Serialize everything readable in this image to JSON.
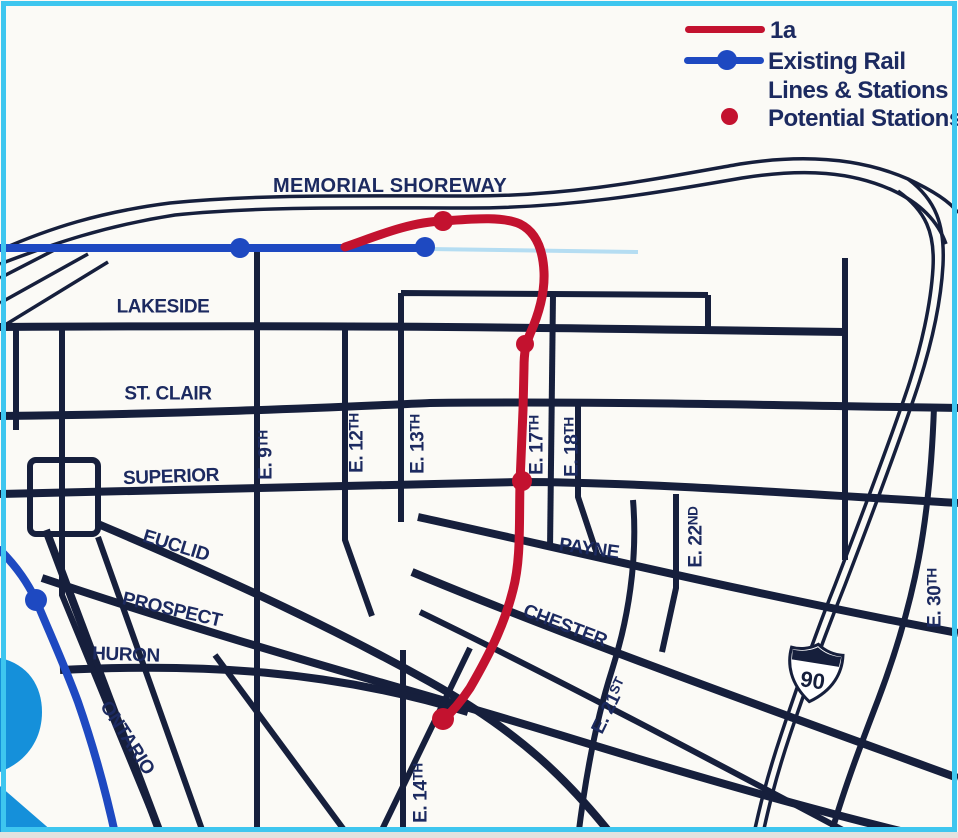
{
  "legend": {
    "route_label": "1a",
    "existing_line1": "Existing Rail",
    "existing_line2": "Lines & Stations",
    "potential_label": "Potential Stations"
  },
  "highway_shield": {
    "number": "90"
  },
  "map": {
    "labels": [
      {
        "id": "memorial-shoreway",
        "main": "MEMORIAL SHOREWAY",
        "suffix": ""
      },
      {
        "id": "lakeside",
        "main": "LAKESIDE",
        "suffix": ""
      },
      {
        "id": "st-clair",
        "main": "ST. CLAIR",
        "suffix": ""
      },
      {
        "id": "superior",
        "main": "SUPERIOR",
        "suffix": ""
      },
      {
        "id": "euclid",
        "main": "EUCLID",
        "suffix": ""
      },
      {
        "id": "prospect",
        "main": "PROSPECT",
        "suffix": ""
      },
      {
        "id": "huron",
        "main": "HURON",
        "suffix": ""
      },
      {
        "id": "ontario",
        "main": "ONTARIO",
        "suffix": ""
      },
      {
        "id": "payne",
        "main": "PAYNE",
        "suffix": ""
      },
      {
        "id": "chester",
        "main": "CHESTER",
        "suffix": ""
      },
      {
        "id": "e9th",
        "main": "E. 9",
        "suffix": "TH"
      },
      {
        "id": "e12th",
        "main": "E. 12",
        "suffix": "TH"
      },
      {
        "id": "e13th",
        "main": "E. 13",
        "suffix": "TH"
      },
      {
        "id": "e17th",
        "main": "E. 17",
        "suffix": "TH"
      },
      {
        "id": "e18th",
        "main": "E. 18",
        "suffix": "TH"
      },
      {
        "id": "e21st",
        "main": "E. 21",
        "suffix": "ST"
      },
      {
        "id": "e22nd",
        "main": "E. 22",
        "suffix": "ND"
      },
      {
        "id": "e30th",
        "main": "E. 30",
        "suffix": "TH"
      },
      {
        "id": "e14th",
        "main": "E. 14",
        "suffix": "TH"
      }
    ],
    "stations": {
      "existing": [
        {
          "x": 240,
          "y": 248,
          "r": 10
        },
        {
          "x": 425,
          "y": 247,
          "r": 10
        },
        {
          "x": 36,
          "y": 600,
          "r": 11
        }
      ],
      "potential": [
        {
          "x": 443,
          "y": 221,
          "r": 10
        },
        {
          "x": 525,
          "y": 344,
          "r": 9
        },
        {
          "x": 522,
          "y": 481,
          "r": 10
        },
        {
          "x": 443,
          "y": 719,
          "r": 11
        }
      ]
    }
  },
  "colors": {
    "street": "#161f3c",
    "rail_blue": "#1e49c1",
    "rail_faded": "#b5ddf2",
    "route_red": "#c3122f",
    "water": "#1590da",
    "frame_cyan": "#3ec6ef",
    "label_text": "#1c2a60",
    "background": "#fbfaf6"
  }
}
